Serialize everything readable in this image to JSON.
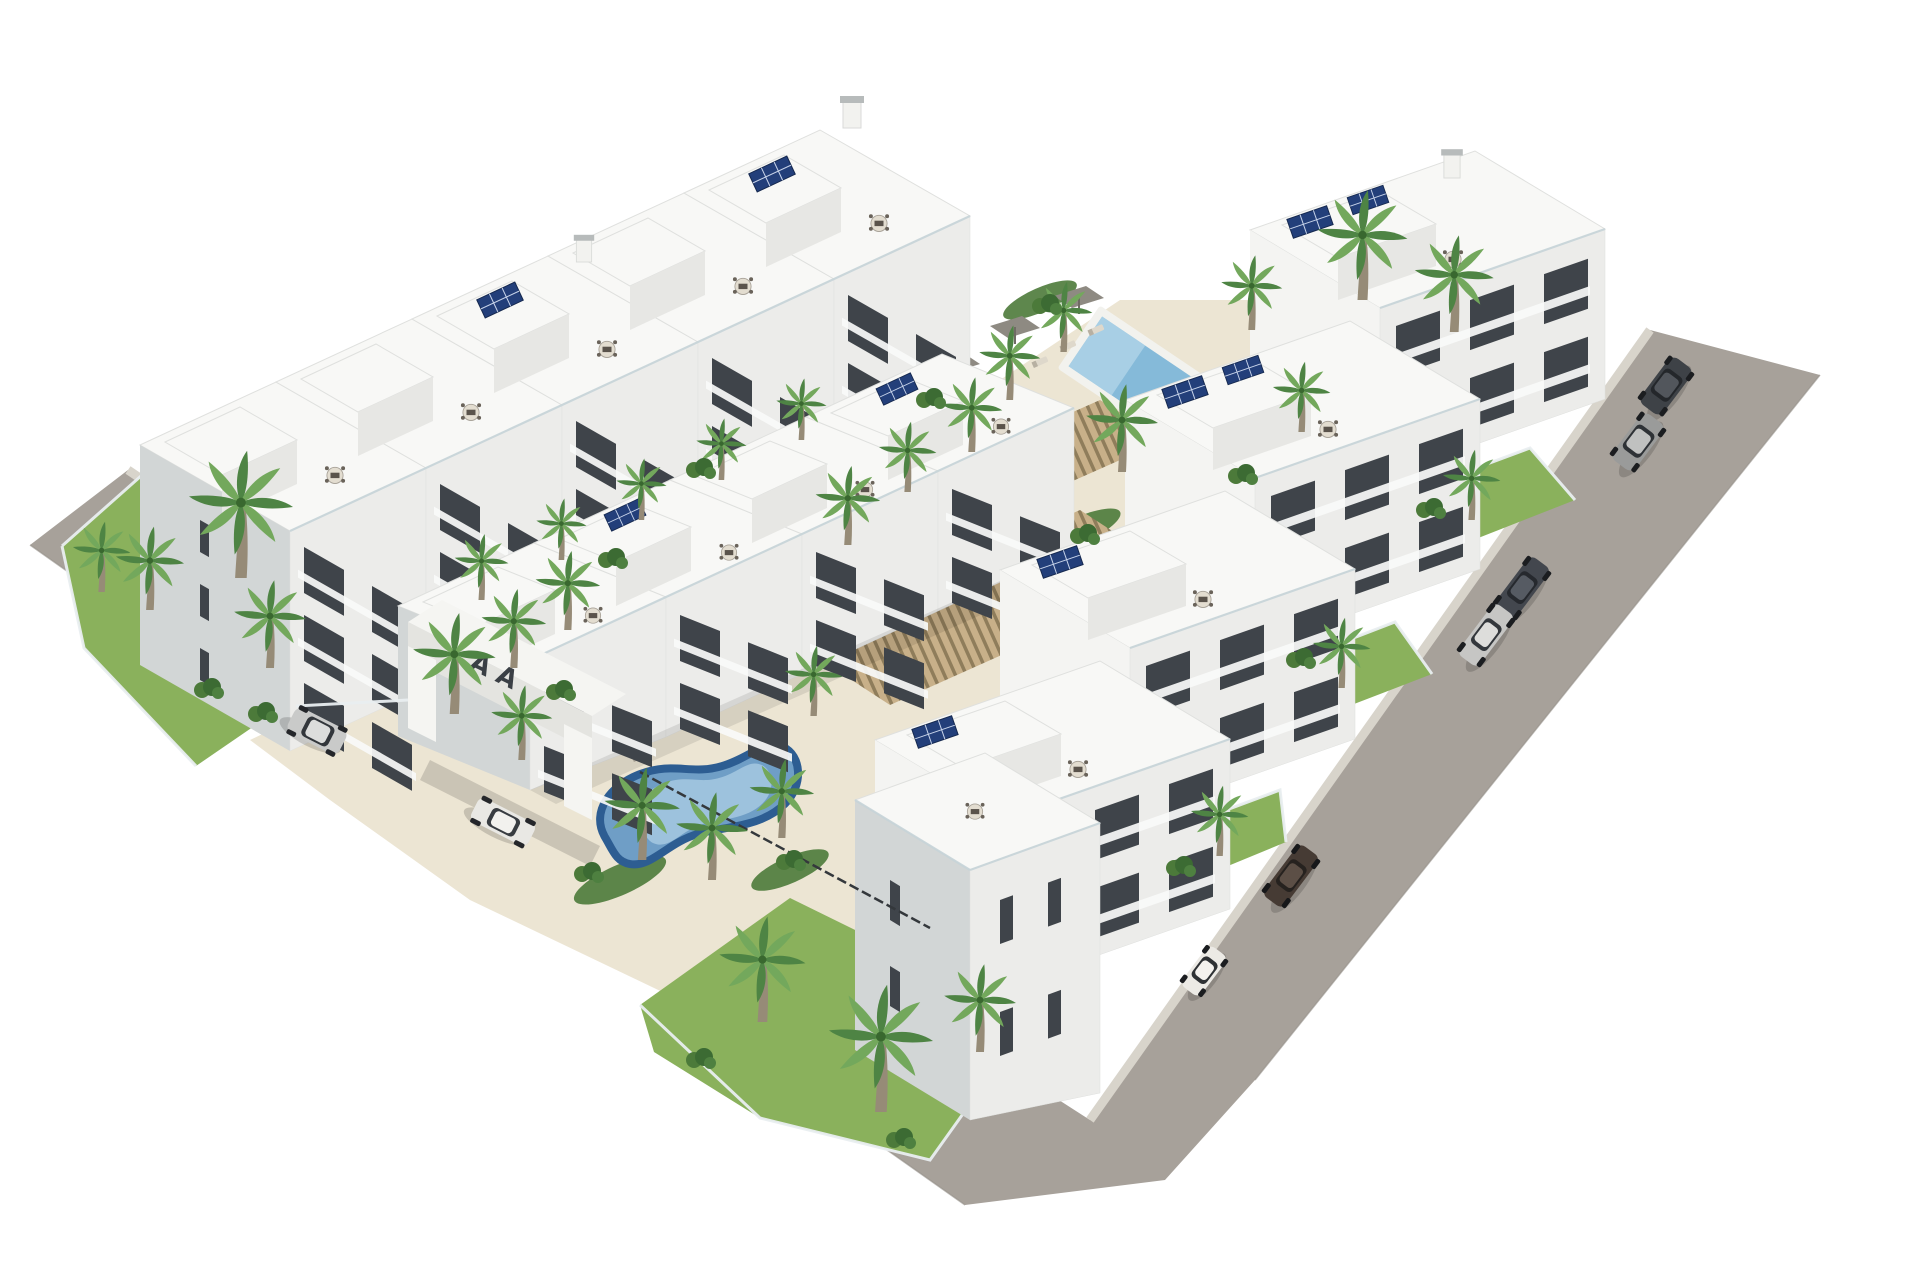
{
  "meta": {
    "title": "Aerial 3D architectural rendering of a white Mediterranean apartment complex",
    "description": "Bird's-eye render of a residential development: white flat-roof apartment blocks with rooftop terraces and solar panels arranged in a U around a landscaped courtyard with a kidney-shaped pool and a rectangular lap pool, wooden pergola decks, palm trees, perimeter roads with parked cars, and a white entrance portal."
  },
  "colors": {
    "bg": "#ffffff",
    "road": "#a7a19a",
    "sidewalk": "#d8d4cb",
    "curb": "#948f88",
    "deck": "#ece5d3",
    "deckShade": "#ddd5c2",
    "lawn": "#8ab15c",
    "bed": "#4c7a3a",
    "shrub": "#3c6b33",
    "palmDark": "#4e8444",
    "palmLight": "#73a85c",
    "trunk": "#968b77",
    "roofWhite": "#f8f8f6",
    "roofLine": "#dfe0de",
    "facade": "#ececea",
    "pentFront": "#e7e7e4",
    "wallSide": "#d2d6d6",
    "wallBright": "#f4f4f2",
    "windowDark": "#3f444a",
    "railing": "#f9faf9",
    "pergWood": "#c8b089",
    "pergGap": "#8f7d5b",
    "poolRim": "#2d5d92",
    "poolWater": "#6f9ec6",
    "poolLight": "#a6c8e0",
    "lapWater": "#85bad9",
    "lapLight": "#b4d6e8",
    "lapRim": "#f2f2ee",
    "solar": "#233f7a",
    "solarLine": "#c8d4ea",
    "shade": "#8e8a82",
    "furn": "#5a534b",
    "furnLight": "#ded8cb",
    "fenceDark": "#34383c",
    "fenceLight": "#e9eef0",
    "gate": "#f5f5f2",
    "gateShade": "#e4e4e0",
    "logo": "#3a3f45",
    "glassRail": "#c7d4d8"
  },
  "scene": {
    "site": {
      "building_rows": [
        {
          "name": "northwest-row",
          "modules": 5,
          "floors": "3-4",
          "features": "stepped white blocks, rooftop terraces, penthouses, balconies"
        },
        {
          "name": "inner-row",
          "modules": 4,
          "floors": 3,
          "features": "parallel inner row facing courtyard pool"
        },
        {
          "name": "east-row",
          "modules": 4,
          "floors": 3,
          "features": "staircase of blocks along east road, rooftop solar panels"
        },
        {
          "name": "corner-tower",
          "modules": 1,
          "floors": 4,
          "features": "tall white tower at south corner with slit windows"
        }
      ],
      "amenities": [
        "kidney-shaped swimming pool",
        "rectangular lap pool",
        "wooden pergola sun decks",
        "sun loungers",
        "parasols",
        "gray shade sails",
        "fenced lawns and gardens"
      ],
      "vegetation": {
        "palm_trees": 33,
        "shrub_clusters": 16,
        "lawns": 5
      },
      "roads": {
        "layout": "L-shaped perimeter roads on southwest and east sides",
        "surface": "gray asphalt with light sidewalks"
      }
    },
    "entrance": {
      "type": "white portal gate on southwest road",
      "logo_text": "A A"
    },
    "vehicles": [
      {
        "name": "silver-suv",
        "color": "#c9cac9",
        "location": "southwest road"
      },
      {
        "name": "white-sedan",
        "color": "#e9e8e4",
        "location": "southwest road"
      },
      {
        "name": "dark-suv",
        "color": "#3e4247",
        "location": "east road top"
      },
      {
        "name": "gray-suv",
        "color": "#9a9b9a",
        "location": "east road top"
      },
      {
        "name": "dark-sedan",
        "color": "#43474e",
        "location": "east road middle"
      },
      {
        "name": "silver-sedan",
        "color": "#c6c6c4",
        "location": "east road middle"
      },
      {
        "name": "brown-car",
        "color": "#463b34",
        "location": "east road bottom"
      },
      {
        "name": "white-hatchback",
        "color": "#eceae5",
        "location": "east road bottom"
      }
    ],
    "solar_panel_arrays": 10,
    "rooftop_dining_sets": 14
  }
}
